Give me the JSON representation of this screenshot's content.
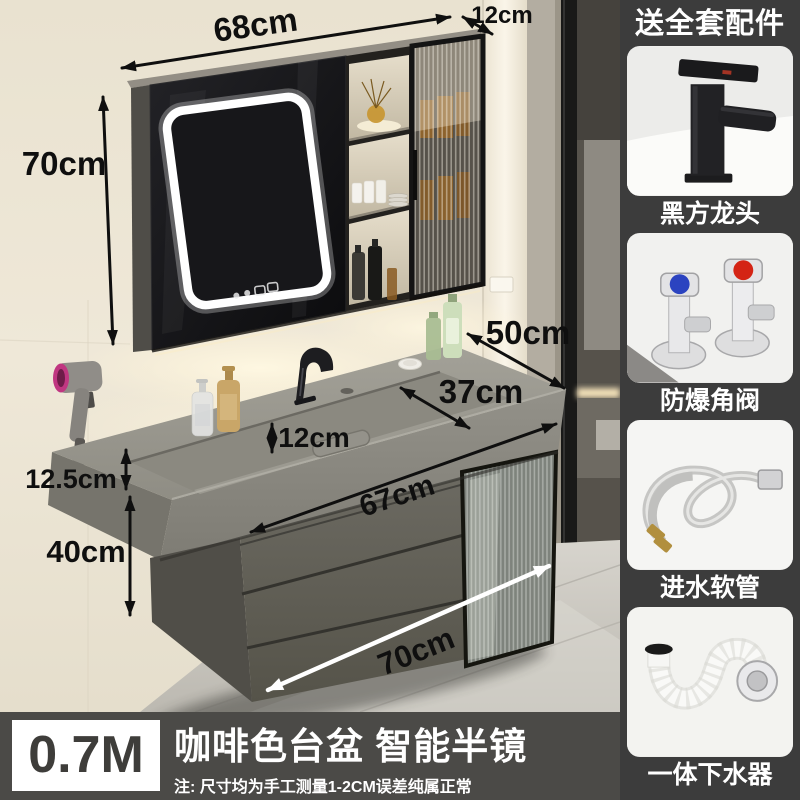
{
  "dims": {
    "mirror_width": "68cm",
    "mirror_depth": "12cm",
    "mirror_height": "70cm",
    "counter_side": "50cm",
    "basin_back_width": "37cm",
    "basin_inner_depth": "12cm",
    "basin_front_width": "67cm",
    "wall_gap": "12.5cm",
    "cabinet_height": "40cm",
    "cabinet_width": "70cm"
  },
  "sidebar": {
    "title": "送全套配件",
    "items": [
      {
        "label": "黑方龙头",
        "icon": "faucet-icon"
      },
      {
        "label": "防爆角阀",
        "icon": "angle-valve-icon"
      },
      {
        "label": "进水软管",
        "icon": "hose-icon"
      },
      {
        "label": "一体下水器",
        "icon": "drain-pipe-icon"
      }
    ]
  },
  "banner": {
    "size_badge": "0.7M",
    "title": "咖啡色台盆 智能半镜",
    "note": "注: 尺寸均为手工测量1-2CM误差纯属正常"
  },
  "colors": {
    "sidebar_bg": "#3c3c3c",
    "banner_bg": "#4b4a47",
    "annotation_black": "#0f0f0f",
    "annotation_white": "#ffffff",
    "wall_cream": "#ece5d4",
    "cabinet_gray": "#64625a",
    "valve_blue": "#2b43c0",
    "valve_red": "#d42415",
    "dryer_pink": "#c03681",
    "led_white": "#ffffff"
  }
}
